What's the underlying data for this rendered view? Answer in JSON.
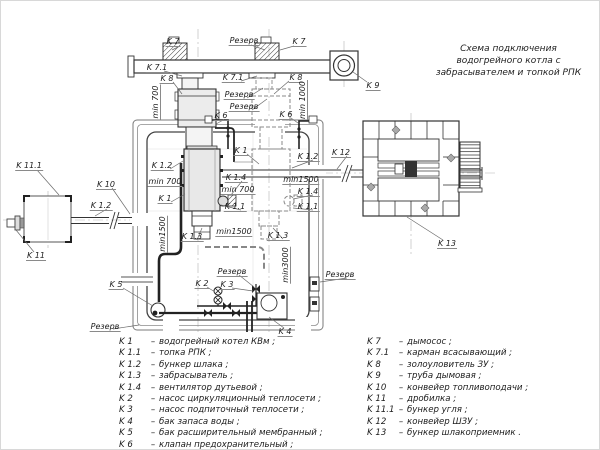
{
  "title": {
    "lines": [
      "Схема подключения",
      "водогрейного котла с",
      "забрасывателем и топкой РПК"
    ]
  },
  "colors": {
    "line": "#333333",
    "reserve_dashed": "#888888",
    "centerline": "#b5b5b5",
    "fill_light": "#e8e8e8",
    "background": "#ffffff"
  },
  "diagram": {
    "labels": [
      {
        "text": "K 7",
        "x": 172,
        "y": 41
      },
      {
        "text": "Резерв",
        "x": 243,
        "y": 40
      },
      {
        "text": "K 7",
        "x": 298,
        "y": 41
      },
      {
        "text": "K 9",
        "x": 372,
        "y": 85
      },
      {
        "text": "K 7.1",
        "x": 156,
        "y": 67
      },
      {
        "text": "K 8",
        "x": 166,
        "y": 78
      },
      {
        "text": "K 7.1",
        "x": 232,
        "y": 77
      },
      {
        "text": "K 8",
        "x": 295,
        "y": 77
      },
      {
        "text": "min 700",
        "x": 155,
        "y": 101,
        "vertical": true
      },
      {
        "text": "min 1000",
        "x": 302,
        "y": 99,
        "vertical": true
      },
      {
        "text": "Резерв",
        "x": 238,
        "y": 94
      },
      {
        "text": "Резерв",
        "x": 243,
        "y": 106
      },
      {
        "text": "K 6",
        "x": 220,
        "y": 115
      },
      {
        "text": "K 6",
        "x": 285,
        "y": 114
      },
      {
        "text": "K 11.1",
        "x": 28,
        "y": 165
      },
      {
        "text": "K 10",
        "x": 105,
        "y": 184
      },
      {
        "text": "K 1.2",
        "x": 100,
        "y": 205
      },
      {
        "text": "K 11",
        "x": 35,
        "y": 255
      },
      {
        "text": "K 1.2",
        "x": 161,
        "y": 165
      },
      {
        "text": "min 700",
        "x": 164,
        "y": 181
      },
      {
        "text": "K 1",
        "x": 164,
        "y": 198
      },
      {
        "text": "K 1",
        "x": 240,
        "y": 150
      },
      {
        "text": "K 1.4",
        "x": 235,
        "y": 177
      },
      {
        "text": "min 700",
        "x": 237,
        "y": 189
      },
      {
        "text": "K 1.1",
        "x": 234,
        "y": 206
      },
      {
        "text": "K 1.2",
        "x": 307,
        "y": 156
      },
      {
        "text": "K 12",
        "x": 340,
        "y": 152
      },
      {
        "text": "min1500",
        "x": 300,
        "y": 179
      },
      {
        "text": "K 1.4",
        "x": 307,
        "y": 191
      },
      {
        "text": "K 1.1",
        "x": 307,
        "y": 206
      },
      {
        "text": "min1500",
        "x": 162,
        "y": 233,
        "vertical": true
      },
      {
        "text": "K 1.3",
        "x": 191,
        "y": 236
      },
      {
        "text": "min1500",
        "x": 233,
        "y": 231
      },
      {
        "text": "K 1.3",
        "x": 277,
        "y": 235
      },
      {
        "text": "Резерв",
        "x": 231,
        "y": 271
      },
      {
        "text": "min3000",
        "x": 285,
        "y": 264,
        "vertical": true
      },
      {
        "text": "Резерв",
        "x": 339,
        "y": 274
      },
      {
        "text": "K 5",
        "x": 115,
        "y": 284
      },
      {
        "text": "K 2",
        "x": 201,
        "y": 283
      },
      {
        "text": "K 3",
        "x": 226,
        "y": 284
      },
      {
        "text": "K 4",
        "x": 284,
        "y": 331
      },
      {
        "text": "Резерв",
        "x": 104,
        "y": 326
      },
      {
        "text": "K 13",
        "x": 446,
        "y": 243
      }
    ]
  },
  "legend": {
    "separator": "–",
    "left": [
      {
        "code": "K 1",
        "desc": "водогрейный котел КВм ;"
      },
      {
        "code": "K 1.1",
        "desc": "топка РПК ;"
      },
      {
        "code": "K 1.2",
        "desc": "бункер шлака ;"
      },
      {
        "code": "K 1.3",
        "desc": "забрасыватель ;"
      },
      {
        "code": "K 1.4",
        "desc": "вентилятор дутьевой ;"
      },
      {
        "code": "K 2",
        "desc": "насос циркуляционный теплосети ;"
      },
      {
        "code": "K 3",
        "desc": "насос подпиточный теплосети ;"
      },
      {
        "code": "K 4",
        "desc": "бак запаса воды ;"
      },
      {
        "code": "K 5",
        "desc": "бак расширительный мембранный ;"
      },
      {
        "code": "K 6",
        "desc": "клапан предохранительный ;"
      }
    ],
    "right": [
      {
        "code": "K 7",
        "desc": "дымосос ;"
      },
      {
        "code": "K 7.1",
        "desc": "карман всасывающий ;"
      },
      {
        "code": "K 8",
        "desc": "золоуловитель ЗУ ;"
      },
      {
        "code": "K 9",
        "desc": "труба дымовая ;"
      },
      {
        "code": "K 10",
        "desc": "конвейер топливоподачи ;"
      },
      {
        "code": "K 11",
        "desc": "дробилка ;"
      },
      {
        "code": "K 11.1",
        "desc": "бункер угля ;"
      },
      {
        "code": "K 12",
        "desc": "конвейер ШЗУ ;"
      },
      {
        "code": "K 13",
        "desc": "бункер шлакоприемник ."
      }
    ]
  }
}
